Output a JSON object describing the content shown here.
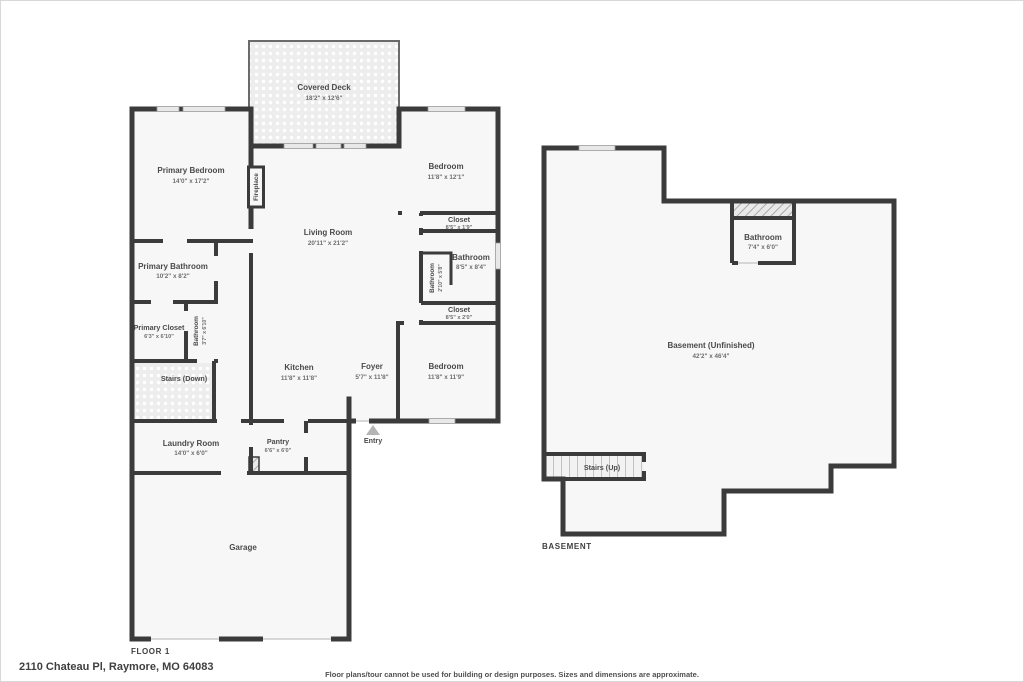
{
  "page": {
    "background": "#ffffff",
    "wall_color": "#3b3b3b",
    "room_fill": "#f7f7f7",
    "label_color": "#4a4a4a"
  },
  "floor1": {
    "floor_label": "FLOOR 1",
    "rooms": {
      "covered_deck": {
        "name": "Covered Deck",
        "dims": "18'2\" x 12'6\""
      },
      "primary_bedroom": {
        "name": "Primary Bedroom",
        "dims": "14'0\" x 17'2\""
      },
      "living_room": {
        "name": "Living Room",
        "dims": "20'11\" x 21'2\""
      },
      "fireplace": {
        "name": "Fireplace"
      },
      "bedroom_upper": {
        "name": "Bedroom",
        "dims": "11'8\" x 12'1\""
      },
      "closet_upper": {
        "name": "Closet",
        "dims": "8'5\" x 1'9\""
      },
      "bathroom_hall": {
        "name": "Bathroom",
        "dims": "8'5\" x 8'4\""
      },
      "bathroom_water": {
        "name": "Bathroom",
        "dims": "2'10\" x 5'8\""
      },
      "closet_lower": {
        "name": "Closet",
        "dims": "8'5\" x 2'0\""
      },
      "bedroom_lower": {
        "name": "Bedroom",
        "dims": "11'8\" x 11'9\""
      },
      "primary_bathroom": {
        "name": "Primary Bathroom",
        "dims": "10'2\" x 8'2\""
      },
      "primary_closet": {
        "name": "Primary Closet",
        "dims": "6'3\" x 6'10\""
      },
      "bathroom_primary_wc": {
        "name": "Bathroom",
        "dims": "3'7\" x 6'10\""
      },
      "stairs_down": {
        "name": "Stairs (Down)"
      },
      "kitchen": {
        "name": "Kitchen",
        "dims": "11'8\" x 11'8\""
      },
      "foyer": {
        "name": "Foyer",
        "dims": "5'7\" x 11'8\""
      },
      "laundry": {
        "name": "Laundry Room",
        "dims": "14'0\" x 6'0\""
      },
      "pantry": {
        "name": "Pantry",
        "dims": "6'6\" x 6'0\""
      },
      "entry": {
        "name": "Entry"
      },
      "garage": {
        "name": "Garage"
      }
    }
  },
  "basement": {
    "floor_label": "BASEMENT",
    "rooms": {
      "main": {
        "name": "Basement (Unfinished)",
        "dims": "42'2\" x 46'4\""
      },
      "bathroom": {
        "name": "Bathroom",
        "dims": "7'4\" x 6'0\""
      },
      "stairs_up": {
        "name": "Stairs (Up)"
      }
    }
  },
  "footer": {
    "address": "2110 Chateau Pl, Raymore, MO 64083",
    "disclaimer": "Floor plans/tour cannot be used for building or design purposes. Sizes and dimensions are approximate."
  }
}
